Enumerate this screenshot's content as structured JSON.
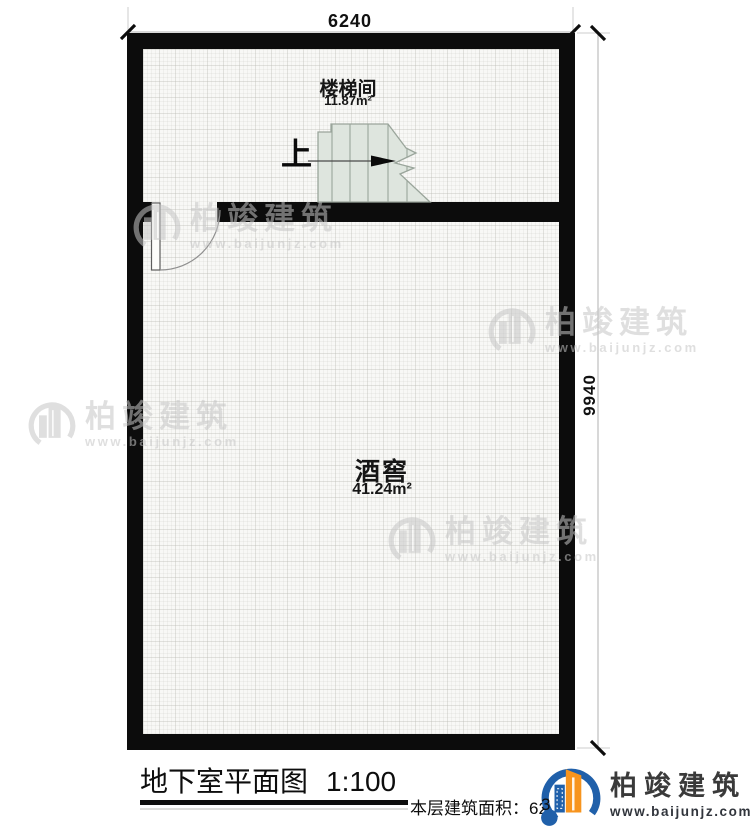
{
  "plan": {
    "dim_top": "6240",
    "dim_right": "9940",
    "stair_direction": "上",
    "rooms": [
      {
        "name": "楼梯间",
        "area": "11.87m²"
      },
      {
        "name": "酒窖",
        "area": "41.24m²"
      }
    ]
  },
  "title_block": {
    "title": "地下室平面图",
    "scale": "1:100",
    "area_label": "本层建筑面积：",
    "area_value": "62.",
    "area_partial_digit": "3"
  },
  "watermark": {
    "name": "柏竣建筑",
    "url": "www.baijunjz.com"
  },
  "logo": {
    "name": "柏竣建筑",
    "url": "www.baijunjz.com"
  },
  "icons": {
    "watermark_icon": "building-logo-icon",
    "logo_icon": "building-logo-icon",
    "stair_arrow": "up-direction-arrow-icon"
  },
  "colors": {
    "wall": "#0c0c0c",
    "stair_fill": "#dee5de",
    "stair_stroke": "#9aa59b",
    "watermark_gray": "#c6c6c6",
    "logo_blue": "#2060aa",
    "logo_orange": "#f7941e"
  }
}
